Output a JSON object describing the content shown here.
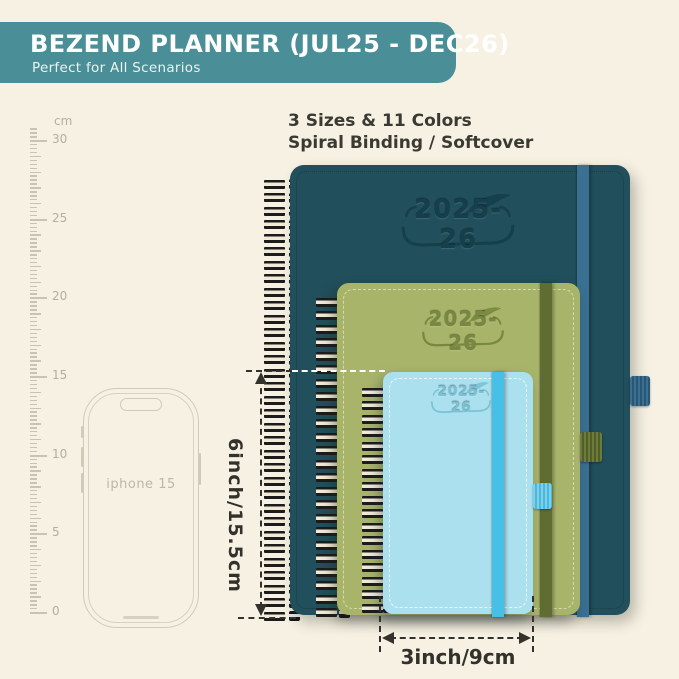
{
  "banner": {
    "title": "BEZEND PLANNER (JUL25 - DEC26)",
    "subtitle": "Perfect for All Scenarios",
    "color": "#4a8e97"
  },
  "intro": {
    "line1": "3 Sizes & 11 Colors",
    "line2": "Spiral Binding / Softcover"
  },
  "ruler": {
    "unit": "cm",
    "labels": [
      {
        "cm": 0,
        "text": "0"
      },
      {
        "cm": 5,
        "text": "5"
      },
      {
        "cm": 10,
        "text": "10"
      },
      {
        "cm": 15,
        "text": "15"
      },
      {
        "cm": 20,
        "text": "20"
      },
      {
        "cm": 25,
        "text": "25"
      },
      {
        "cm": 30,
        "text": "30"
      }
    ]
  },
  "phone": {
    "label": "iphone 15"
  },
  "planners": {
    "large": {
      "year": "2025-26",
      "cover_color": "#214f5b",
      "band_color": "#3b7093",
      "emboss_color": "#143f4b"
    },
    "medium": {
      "year": "2025-26",
      "cover_color": "#a9b46b",
      "band_color": "#5f6d33",
      "emboss_color": "#78883f"
    },
    "small": {
      "year": "2025-26",
      "cover_color": "#abe0ee",
      "band_color": "#47c0e8",
      "emboss_color": "#79c2d6"
    }
  },
  "dimensions": {
    "height_label": "6inch/15.5cm",
    "width_label": "3inch/9cm"
  },
  "colors": {
    "background": "#f6f1e3",
    "body_text": "#3a3a33",
    "ruler_gray": "#c8c3b4",
    "phone_outline": "#cfcaba",
    "dimension_ink": "#33312c"
  }
}
